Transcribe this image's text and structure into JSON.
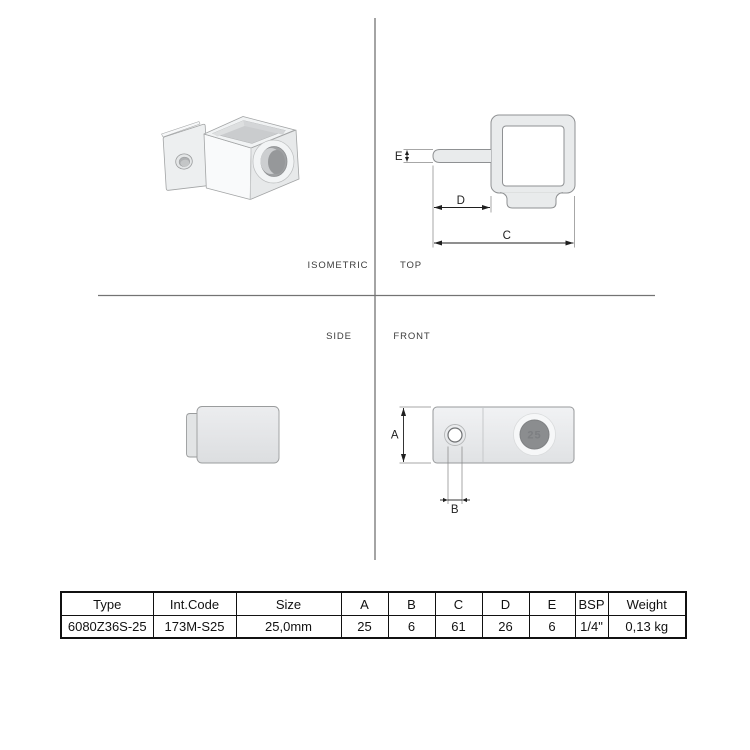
{
  "views": {
    "isometric": {
      "label": "ISOMETRIC"
    },
    "top": {
      "label": "TOP",
      "dim_c": "C",
      "dim_d": "D",
      "dim_e": "E"
    },
    "side": {
      "label": "SIDE"
    },
    "front": {
      "label": "FRONT",
      "dim_a": "A",
      "dim_b": "B",
      "bore_marking": "25"
    }
  },
  "spec_table": {
    "headers": [
      "Type",
      "Int.Code",
      "Size",
      "A",
      "B",
      "C",
      "D",
      "E",
      "BSP",
      "Weight"
    ],
    "row": [
      "6080Z36S-25",
      "173M-S25",
      "25,0mm",
      "25",
      "6",
      "61",
      "26",
      "6",
      "1/4\"",
      "0,13 kg"
    ]
  },
  "colors": {
    "part_fill": "#e9ebec",
    "part_outline": "#8f9193",
    "dimension_line": "#1f1f1f",
    "extension_line": "#8a8a8a",
    "divider_line": "#737373",
    "bore_dark": "#8b8d8f",
    "table_border": "#111111"
  }
}
